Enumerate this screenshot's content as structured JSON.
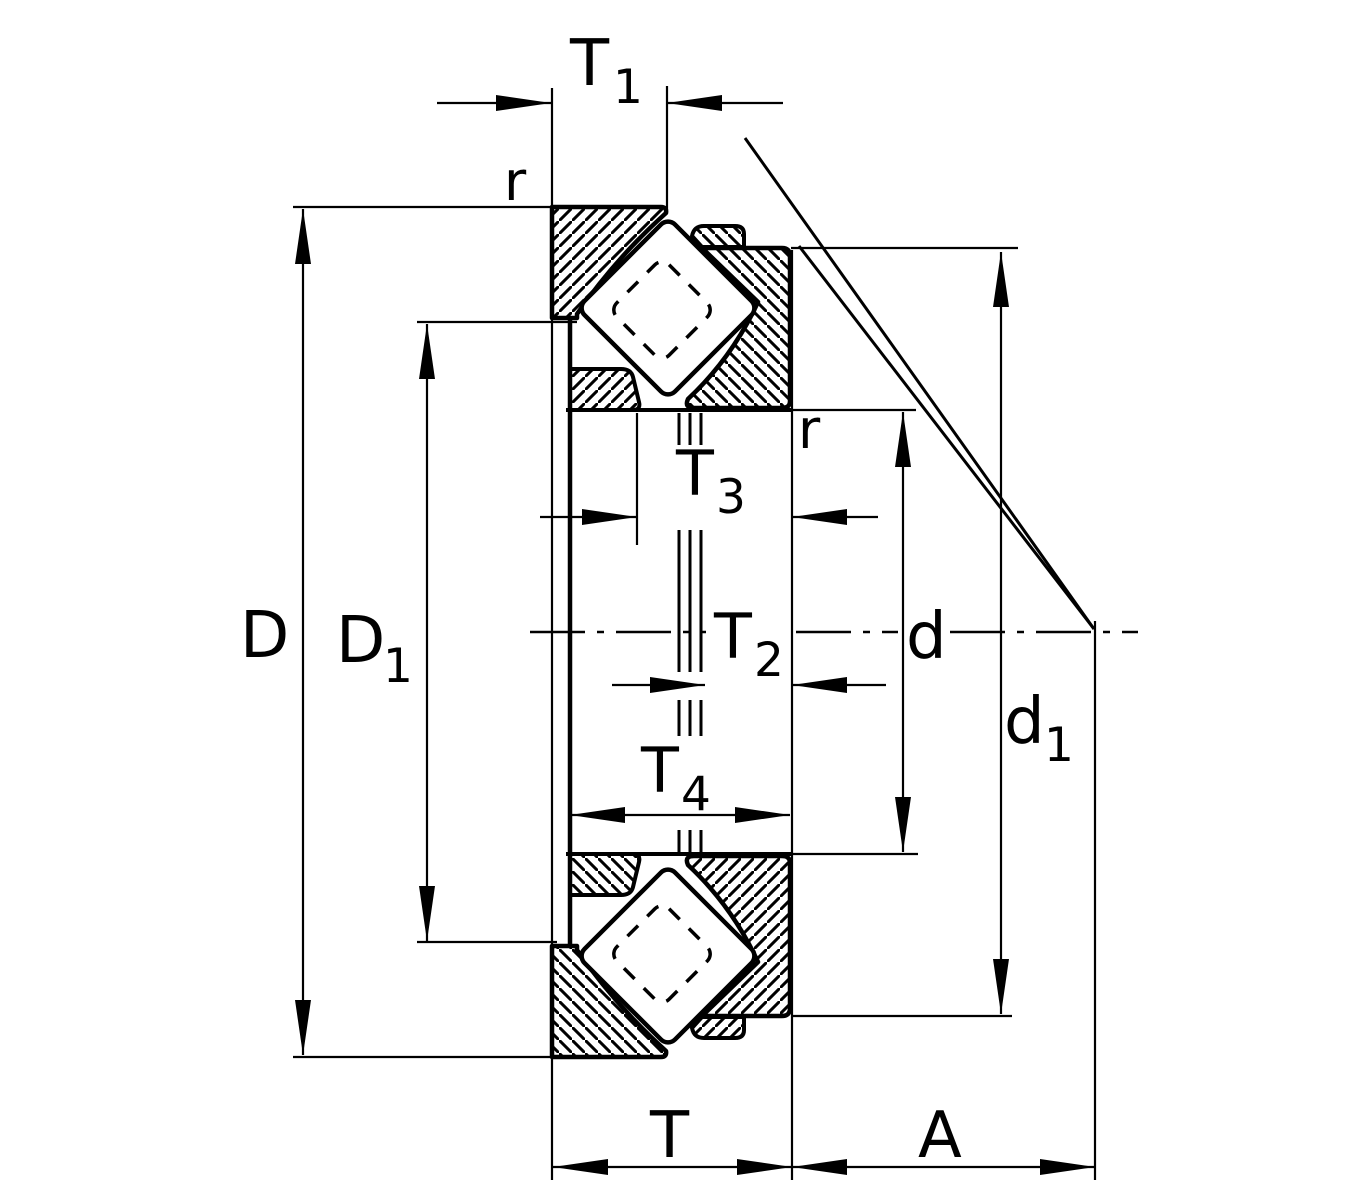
{
  "drawing": {
    "kind": "bearing-cross-section-dimension-drawing",
    "colors": {
      "line": "#000000",
      "background": "#ffffff"
    },
    "labels": {
      "t1": {
        "main": "T",
        "sub": "1"
      },
      "r_top": {
        "main": "r"
      },
      "r_mid": {
        "main": "r"
      },
      "t3": {
        "main": "T",
        "sub": "3"
      },
      "t2": {
        "main": "T",
        "sub": "2"
      },
      "t4": {
        "main": "T",
        "sub": "4"
      },
      "D": {
        "main": "D"
      },
      "D1": {
        "main": "D",
        "sub": "1"
      },
      "d": {
        "main": "d"
      },
      "d1": {
        "main": "d",
        "sub": "1"
      },
      "T": {
        "main": "T"
      },
      "A": {
        "main": "A"
      }
    }
  }
}
